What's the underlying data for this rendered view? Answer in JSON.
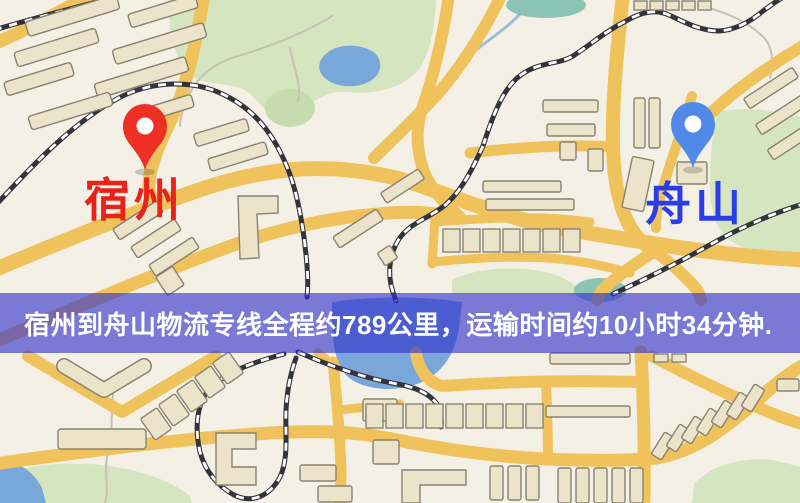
{
  "banner": {
    "text": "宿州到舟山物流专线全程约789公里，运输时间约10小时34分钟.",
    "distance": "789公里",
    "duration": "10小时34分钟"
  },
  "origin": {
    "label": "宿州"
  },
  "destination": {
    "label": "舟山"
  },
  "theme": {
    "background": "#f5f0e5",
    "road": "#f0c25c",
    "park": "#d5e5c0",
    "park_dark": "#c6dcae",
    "water": "#79a7d9",
    "pond_teal": "#8cc4b4",
    "building": "#ece4ca",
    "building_outline": "#8a8270",
    "railway": "#33333b",
    "path": "#c6c1b2",
    "banner_bg": "#3232cda1",
    "banner_text": "#ffffff",
    "origin_pin": "#ee2f24",
    "destination_pin": "#5089e8",
    "origin_label_color": "#e8231a",
    "destination_label_color": "#2a3ee8"
  }
}
